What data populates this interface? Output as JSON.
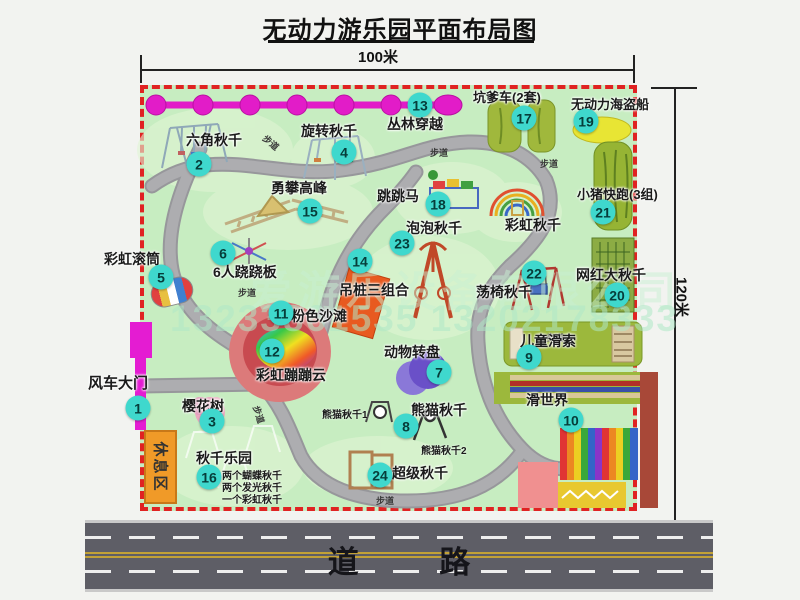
{
  "title": "无动力游乐园平面布局图",
  "dimensions": {
    "width": "100米",
    "height": "120米"
  },
  "road": {
    "label": "道 路"
  },
  "watermark": {
    "company": "爱游乐设备有限公司",
    "phone": "13233861535 13202178333"
  },
  "rest_area": "休息区",
  "path_label": "步道",
  "attractions": [
    {
      "num": "1",
      "name": "风车大门"
    },
    {
      "num": "2",
      "name": "六角秋千"
    },
    {
      "num": "3",
      "name": "樱花树"
    },
    {
      "num": "4",
      "name": "旋转秋千"
    },
    {
      "num": "5",
      "name": "彩虹滚筒"
    },
    {
      "num": "6",
      "name": "6人跷跷板"
    },
    {
      "num": "7",
      "name": "动物转盘"
    },
    {
      "num": "8",
      "name": "熊猫秋千"
    },
    {
      "num": "9",
      "name": "儿童滑索"
    },
    {
      "num": "10",
      "name": "滑世界"
    },
    {
      "num": "11",
      "name": "粉色沙滩"
    },
    {
      "num": "12",
      "name": "彩虹蹦蹦云"
    },
    {
      "num": "13",
      "name": "丛林穿越"
    },
    {
      "num": "14",
      "name": "吊桩三组合"
    },
    {
      "num": "15",
      "name": "勇攀高峰"
    },
    {
      "num": "16",
      "name": "秋千乐园"
    },
    {
      "num": "17",
      "name": "坑爹车(2套)"
    },
    {
      "num": "18",
      "name": "跳跳马"
    },
    {
      "num": "19",
      "name": "无动力海盗船"
    },
    {
      "num": "20",
      "name": "网红大秋千"
    },
    {
      "num": "21",
      "name": "小猪快跑(3组)"
    },
    {
      "num": "22",
      "name": "荡椅秋千"
    },
    {
      "num": "23",
      "name": "泡泡秋千"
    },
    {
      "num": "24",
      "name": "超级秋千"
    }
  ],
  "extras": {
    "rainbow_swing": "彩虹秋千",
    "panda_swing_1": "熊猫秋千1",
    "panda_swing_2": "熊猫秋千2",
    "note_1": "两个蝴蝶秋千",
    "note_2": "两个发光秋千",
    "note_3": "一个彩虹秋千"
  }
}
